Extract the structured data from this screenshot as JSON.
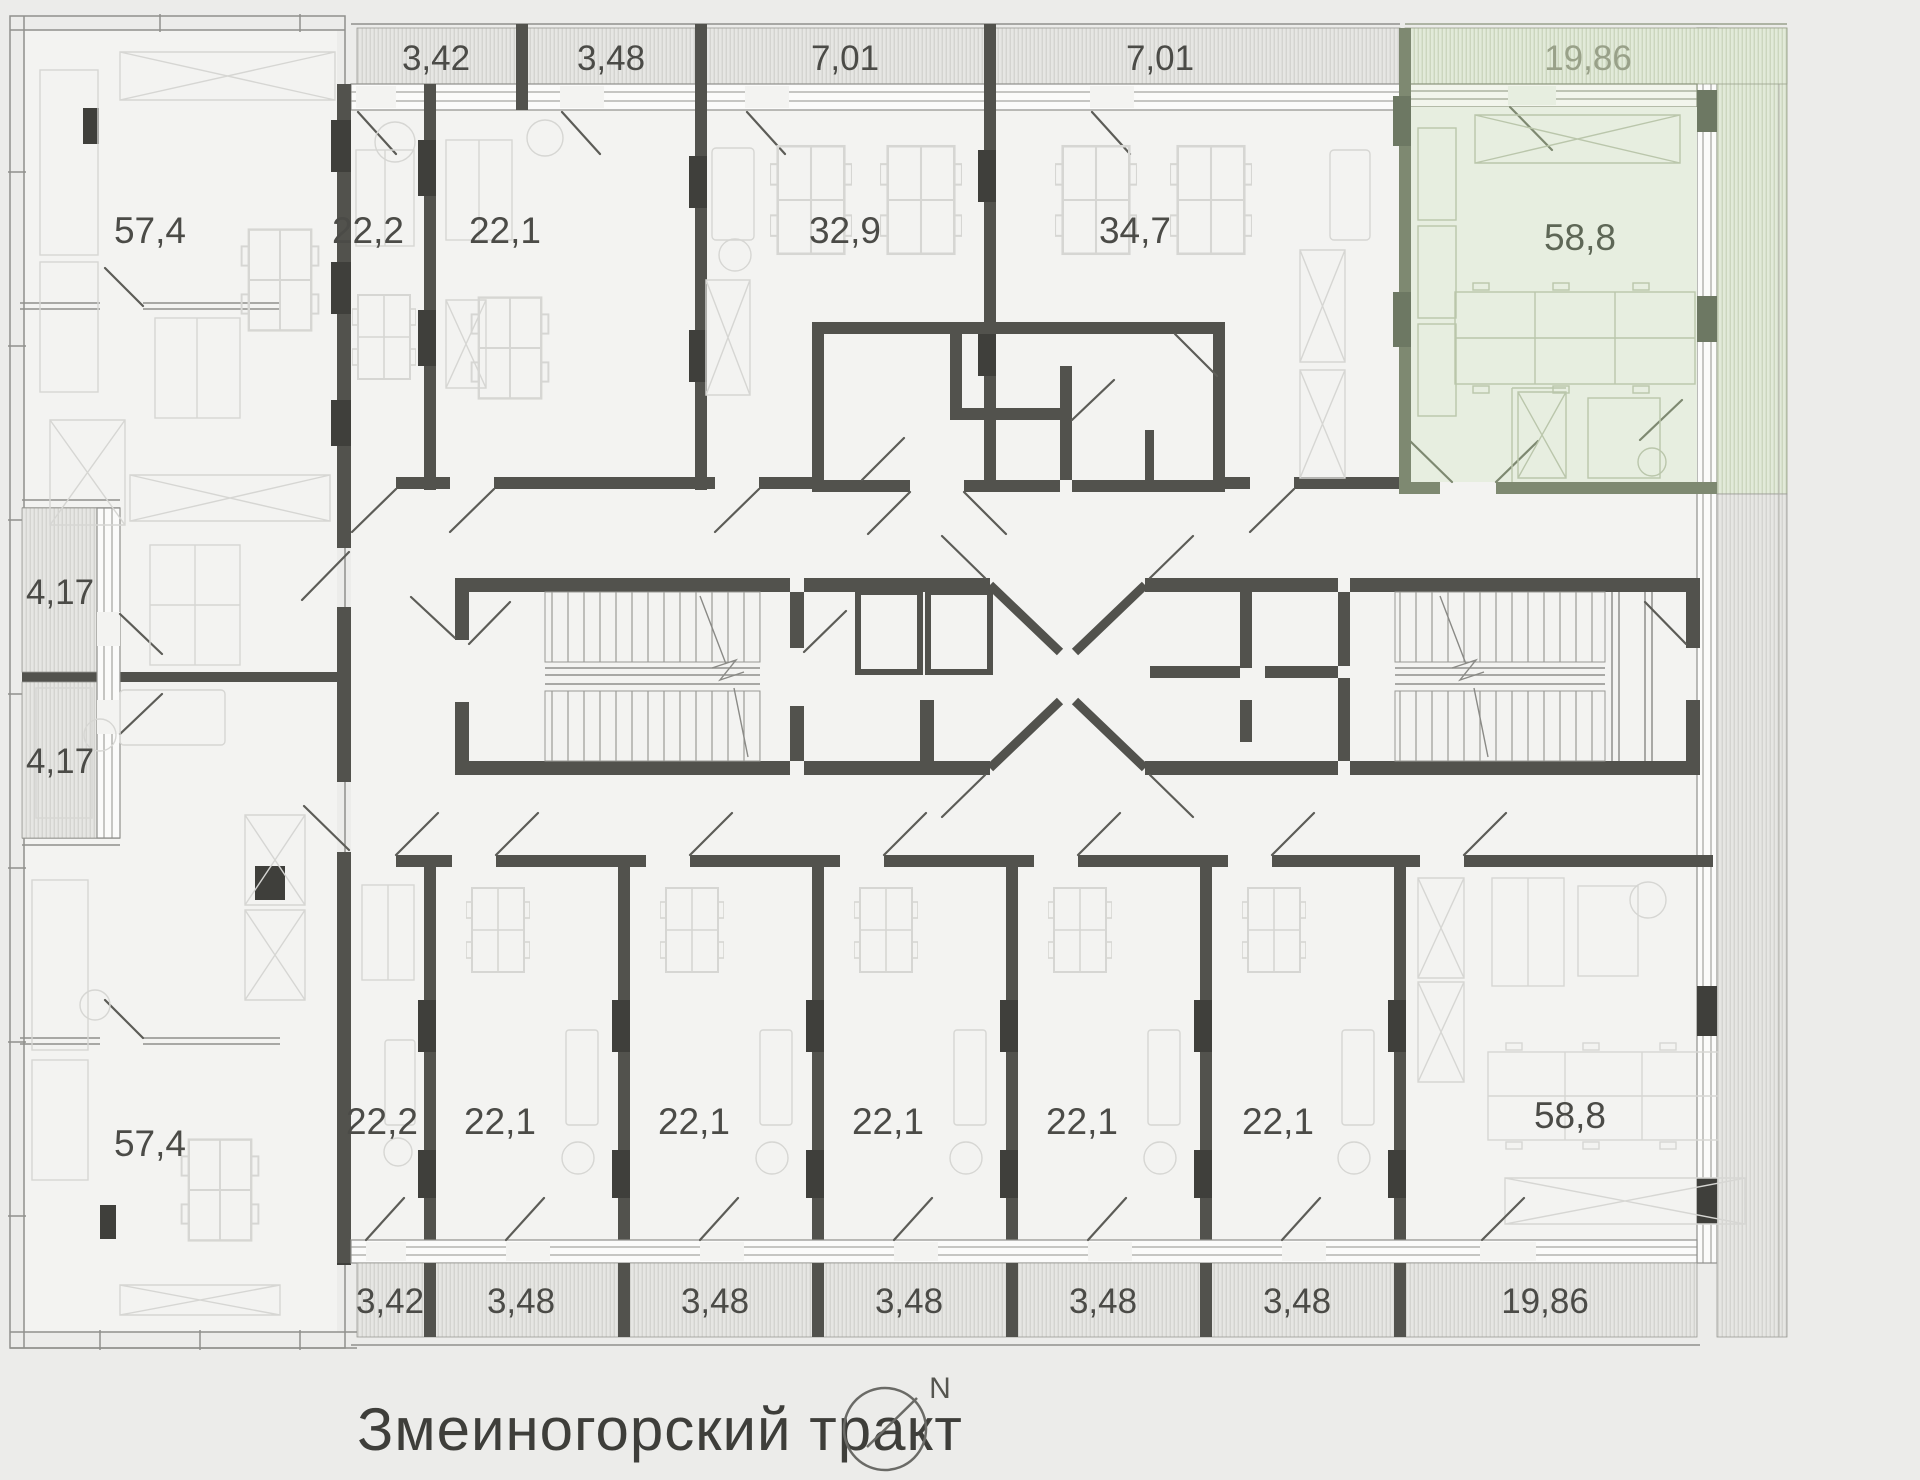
{
  "plan": {
    "street_label": "Змеиногорский тракт",
    "compass": {
      "north_label": "N"
    },
    "colors": {
      "highlight_fill": "#e7eee0",
      "highlight_wall": "#7e8971",
      "wall": "#52524d",
      "background": "#ececea"
    },
    "left_wing": {
      "top_office": "57,4",
      "balcony_top": "4,17",
      "balcony_bottom": "4,17",
      "bottom_office": "57,4"
    },
    "north_row": {
      "balconies": [
        "3,42",
        "3,48",
        "7,01",
        "7,01"
      ],
      "units": [
        "22,2",
        "22,1",
        "32,9",
        "34,7"
      ]
    },
    "highlight_unit": {
      "area": "58,8",
      "balcony": "19,86"
    },
    "south_row": {
      "units": [
        "22,2",
        "22,1",
        "22,1",
        "22,1",
        "22,1",
        "22,1",
        "58,8"
      ],
      "balconies": [
        "3,42",
        "3,48",
        "3,48",
        "3,48",
        "3,48",
        "3,48",
        "19,86"
      ]
    }
  }
}
